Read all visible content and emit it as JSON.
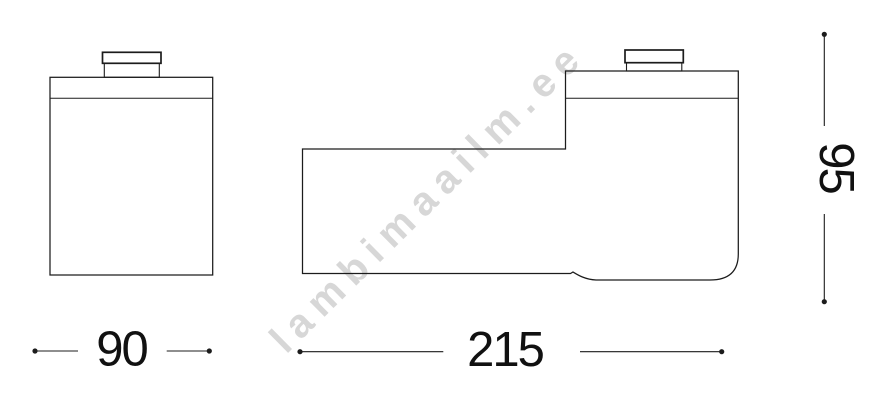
{
  "watermark": {
    "text": "lambimaailm.ee",
    "color": "#d7d7d7"
  },
  "drawing": {
    "line_color": "#1c1c1c",
    "label_color": "#111111",
    "background_color": "#ffffff",
    "dimensions": {
      "front_width": {
        "value": "90",
        "orientation": "horizontal"
      },
      "side_length": {
        "value": "215",
        "orientation": "horizontal"
      },
      "side_height": {
        "value": "95",
        "orientation": "vertical"
      }
    }
  }
}
